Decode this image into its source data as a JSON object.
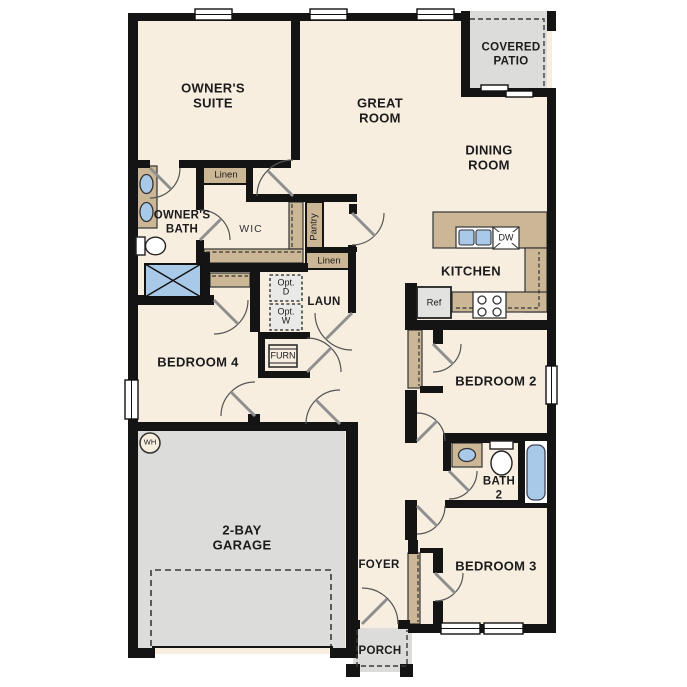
{
  "colors": {
    "wall": "#141414",
    "floor": "#f7eee0",
    "accent_tan": "#cbb795",
    "area_gray": "#dcdcda",
    "fixture_blue": "#a9c9e9",
    "optbox": "#e9e9e8",
    "text": "#1b1b1b"
  },
  "labels": {
    "owners_suite": "OWNER'S\nSUITE",
    "great_room": "GREAT\nROOM",
    "covered_patio": "COVERED\nPATIO",
    "dining_room": "DINING\nROOM",
    "kitchen": "KITCHEN",
    "owners_bath": "OWNER'S\nBATH",
    "wic": "WIC",
    "linen_1": "Linen",
    "pantry": "Pantry",
    "linen_2": "Linen",
    "laundry": "LAUN",
    "opt_dryer": "Opt.\nD",
    "opt_washer": "Opt.\nW",
    "furnace": "FURN",
    "bedroom_4": "BEDROOM 4",
    "bedroom_2": "BEDROOM 2",
    "bedroom_3": "BEDROOM 3",
    "bath_2": "BATH\n2",
    "garage": "2-BAY\nGARAGE",
    "foyer": "FOYER",
    "porch": "PORCH",
    "refrigerator": "Ref",
    "dishwasher": "DW",
    "water_heater": "WH"
  }
}
